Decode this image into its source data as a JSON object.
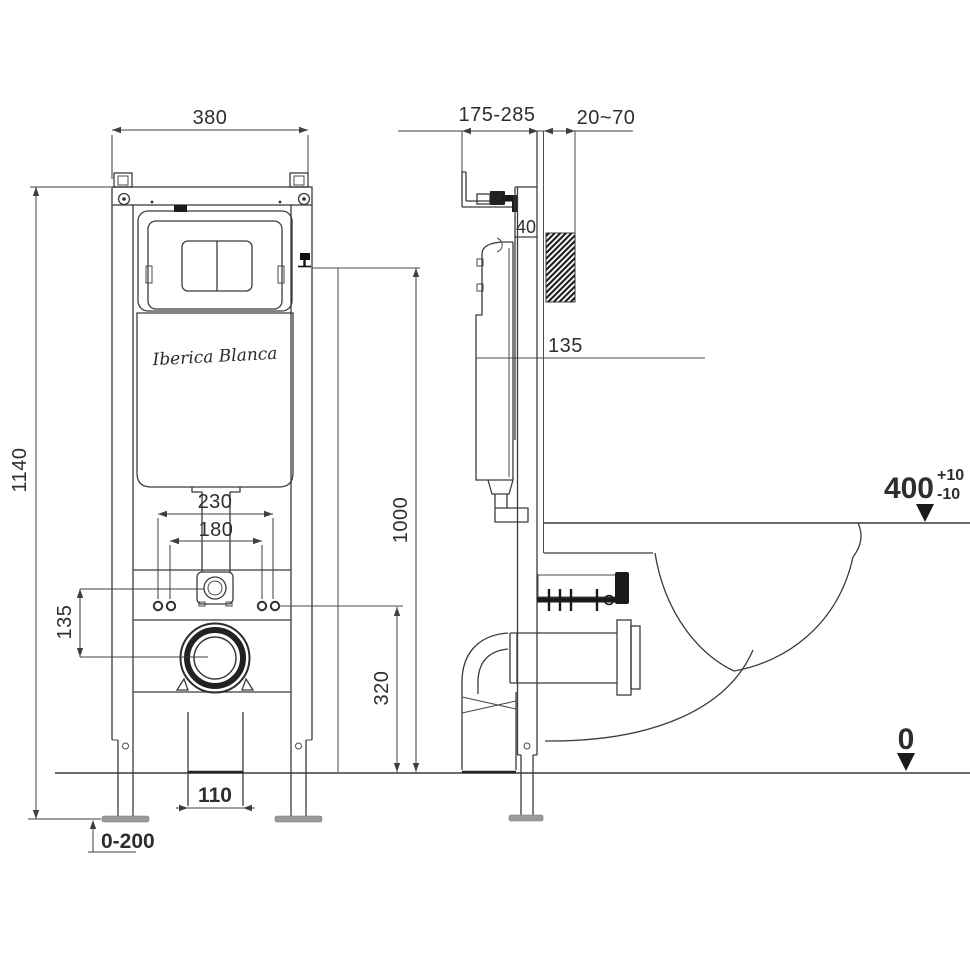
{
  "brand": {
    "logo_text": "Iberica Blanca"
  },
  "front_view": {
    "frame_width": "380",
    "frame_height": "1140",
    "bolt_spacing_outer": "230",
    "bolt_spacing_inner": "180",
    "inlet_to_drain_offset": "135",
    "drain_outlet_width": "110",
    "leg_adjustment_range": "0-200",
    "water_inlet_height": "1000",
    "fixing_bolt_height": "320"
  },
  "side_view": {
    "top_bracket_range": "175-285",
    "wall_finish_thickness": "20~70",
    "rail_depth": "40",
    "cistern_offset": "135",
    "bowl_rim_height": "400",
    "rim_tolerance_plus": "+10",
    "rim_tolerance_minus": "-10",
    "floor_level": "0"
  }
}
